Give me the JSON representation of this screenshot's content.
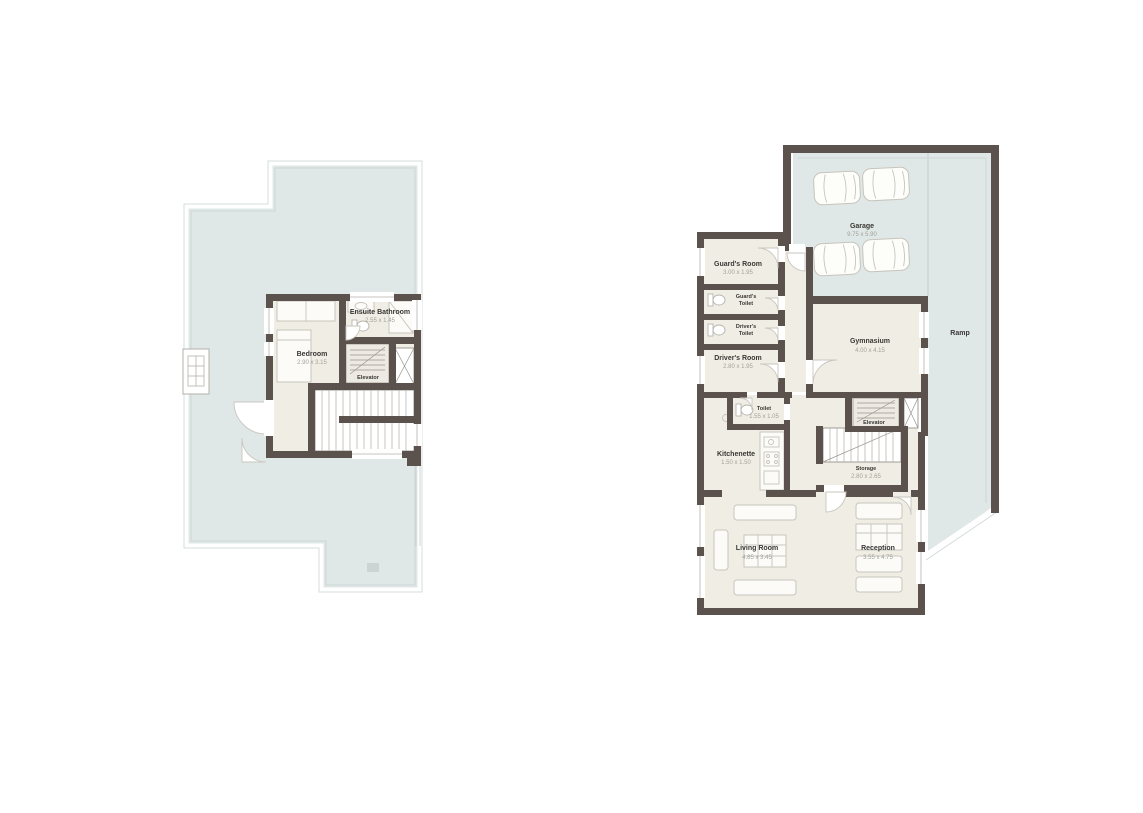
{
  "colors": {
    "background": "#ffffff",
    "wall": "#5b524d",
    "terrace_fill": "#dfe8e7",
    "room_fill": "#f0eee4",
    "label_text": "#3a3734",
    "dimension_text": "#a3a09a"
  },
  "upper_plan": {
    "bedroom": {
      "name": "Bedroom",
      "dims": "2.90 x 3.15"
    },
    "ensuite_bathroom": {
      "name": "Ensuite Bathroom",
      "dims": "2.55 x 1.45"
    },
    "elevator": {
      "name": "Elevator"
    }
  },
  "ground_plan": {
    "garage": {
      "name": "Garage",
      "dims": "9.75 x 5.90"
    },
    "ramp": {
      "name": "Ramp"
    },
    "guards_room": {
      "name": "Guard's Room",
      "dims": "3.00 x 1.95"
    },
    "guards_toilet": {
      "line1": "Guard's",
      "line2": "Toilet"
    },
    "drivers_toilet": {
      "line1": "Driver's",
      "line2": "Toilet"
    },
    "drivers_room": {
      "name": "Driver's Room",
      "dims": "2.80 x 1.95"
    },
    "gymnasium": {
      "name": "Gymnasium",
      "dims": "4.00 x 4.15"
    },
    "elevator": {
      "name": "Elevator"
    },
    "toilet": {
      "name": "Toilet",
      "dims": "1.55 x 1.05"
    },
    "kitchenette": {
      "name": "Kitchenette",
      "dims": "1.50 x 1.50"
    },
    "storage": {
      "name": "Storage",
      "dims": "2.80 x 2.65"
    },
    "living_room": {
      "name": "Living Room",
      "dims": "4.85 x 3.45"
    },
    "reception": {
      "name": "Reception",
      "dims": "3.55 x 4.75"
    }
  }
}
